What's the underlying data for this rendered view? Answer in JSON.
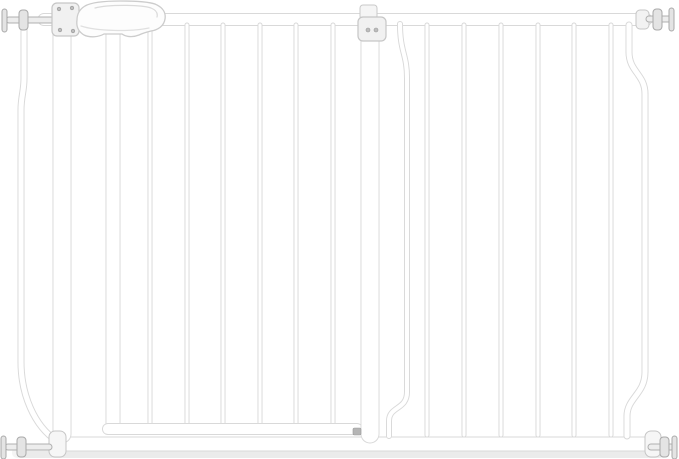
{
  "meta": {
    "width": 679,
    "height": 459,
    "background": "#ffffff",
    "subject": "white-metal-baby-safety-gate-with-extension"
  },
  "palette": {
    "tube_fill": "#ffffff",
    "tube_stroke": "#d9d9d9",
    "hardware_fill": "#f2f2f2",
    "hardware_stroke": "#c6c6c6",
    "bolt_fill": "#e4e4e4",
    "bolt_stroke": "#a9a9a9",
    "screw_fill": "#bdbdbd",
    "screw_stroke": "#999999",
    "latch_pin": "#b5b5b5",
    "shadow_soft": "#f4f4f4",
    "shadow_main": "#ebebeb"
  },
  "scene": {
    "shapes": [
      {
        "type": "rect",
        "name": "floor-shadow-soft",
        "attrs": {
          "x": 12,
          "y": 447,
          "width": 656,
          "height": 11,
          "rx": 5,
          "fill": "#f4f4f4"
        }
      },
      {
        "type": "rect",
        "name": "floor-shadow",
        "attrs": {
          "x": 22,
          "y": 451,
          "width": 640,
          "height": 7,
          "rx": 3,
          "fill": "#ebebeb"
        }
      },
      {
        "type": "tube",
        "name": "top-rail",
        "d": "M44,19.5 H646",
        "w": 13
      },
      {
        "type": "tube",
        "name": "bottom-rail",
        "d": "M57,444 H650",
        "w": 15
      },
      {
        "type": "tube",
        "name": "left-outer-bent-bar",
        "d": "M24,28 V78 C24,92 21,96 21,110 V362 C21,394 34,426 57,441",
        "w": 7
      },
      {
        "type": "tube",
        "name": "frame-hinge-post",
        "d": "M62,30 V434",
        "w": 19
      },
      {
        "type": "tube",
        "name": "door-hinge-stile",
        "d": "M113,30 V423",
        "w": 15
      },
      {
        "type": "tube",
        "name": "door-bar-1",
        "d": "M150,25 V424",
        "w": 5
      },
      {
        "type": "tube",
        "name": "door-bar-2",
        "d": "M187,25 V424",
        "w": 5
      },
      {
        "type": "tube",
        "name": "door-bar-3",
        "d": "M223,25 V424",
        "w": 5
      },
      {
        "type": "tube",
        "name": "door-bar-4",
        "d": "M260,25 V424",
        "w": 5
      },
      {
        "type": "tube",
        "name": "door-bar-5",
        "d": "M296,25 V424",
        "w": 5
      },
      {
        "type": "tube",
        "name": "door-bar-6",
        "d": "M333,25 V424",
        "w": 5
      },
      {
        "type": "tube",
        "name": "door-bottom-rail",
        "d": "M108,429 H357",
        "w": 12
      },
      {
        "type": "tube",
        "name": "frame-latch-post",
        "d": "M370,32 V434",
        "w": 19
      },
      {
        "type": "tube",
        "name": "extension-offset-bar",
        "d": "M400,24 C400,52 407,54 407,78 V392 C407,410 389,406 389,421 V436",
        "w": 6
      },
      {
        "type": "tube",
        "name": "extension-bar-1",
        "d": "M427,25 V435",
        "w": 5
      },
      {
        "type": "tube",
        "name": "extension-bar-2",
        "d": "M464,25 V435",
        "w": 5
      },
      {
        "type": "tube",
        "name": "extension-bar-3",
        "d": "M501,25 V435",
        "w": 5
      },
      {
        "type": "tube",
        "name": "extension-bar-4",
        "d": "M538,25 V435",
        "w": 5
      },
      {
        "type": "tube",
        "name": "extension-bar-5",
        "d": "M574,25 V435",
        "w": 5
      },
      {
        "type": "tube",
        "name": "extension-bar-6",
        "d": "M611,25 V435",
        "w": 5
      },
      {
        "type": "tube",
        "name": "right-outer-bent-bar",
        "d": "M629,25 V52 C629,72 645,74 645,94 V372 C645,394 627,398 627,416 V436",
        "w": 7
      },
      {
        "type": "rect",
        "name": "top-rail-right-collar",
        "attrs": {
          "x": 636,
          "y": 10,
          "width": 13,
          "height": 19,
          "rx": 4,
          "fill": "#f2f2f2",
          "stroke": "#c6c6c6",
          "stroke-width": 1
        }
      },
      {
        "type": "rect",
        "name": "bottom-rail-left-cap",
        "attrs": {
          "x": 49,
          "y": 431,
          "width": 17,
          "height": 26,
          "rx": 6,
          "fill": "#f6f6f6",
          "stroke": "#c6c6c6",
          "stroke-width": 1
        }
      },
      {
        "type": "rect",
        "name": "bottom-rail-right-cap",
        "attrs": {
          "x": 645,
          "y": 431,
          "width": 16,
          "height": 26,
          "rx": 6,
          "fill": "#f6f6f6",
          "stroke": "#c6c6c6",
          "stroke-width": 1
        }
      },
      {
        "type": "rect",
        "name": "pressure-bolt-top-left-spindle",
        "attrs": {
          "x": 6,
          "y": 17,
          "width": 50,
          "height": 6,
          "rx": 3,
          "fill": "#ededed",
          "stroke": "#b0b0b0",
          "stroke-width": 1
        }
      },
      {
        "type": "rect",
        "name": "pressure-bolt-top-left-handle",
        "attrs": {
          "x": 2,
          "y": 9,
          "width": 5,
          "height": 23,
          "rx": 2.5,
          "fill": "#e4e4e4",
          "stroke": "#a9a9a9",
          "stroke-width": 1
        }
      },
      {
        "type": "rect",
        "name": "pressure-bolt-top-left-disc",
        "attrs": {
          "x": 19,
          "y": 10,
          "width": 9,
          "height": 20,
          "rx": 3.5,
          "fill": "#e4e4e4",
          "stroke": "#a9a9a9",
          "stroke-width": 1
        }
      },
      {
        "type": "rect",
        "name": "pressure-bolt-top-right-spindle",
        "attrs": {
          "x": 646,
          "y": 16,
          "width": 26,
          "height": 6,
          "rx": 3,
          "fill": "#ededed",
          "stroke": "#b0b0b0",
          "stroke-width": 1
        }
      },
      {
        "type": "rect",
        "name": "pressure-bolt-top-right-disc",
        "attrs": {
          "x": 653,
          "y": 9,
          "width": 9,
          "height": 21,
          "rx": 3.5,
          "fill": "#e4e4e4",
          "stroke": "#a9a9a9",
          "stroke-width": 1
        }
      },
      {
        "type": "rect",
        "name": "pressure-bolt-top-right-handle",
        "attrs": {
          "x": 669,
          "y": 8,
          "width": 5,
          "height": 23,
          "rx": 2.5,
          "fill": "#e4e4e4",
          "stroke": "#a9a9a9",
          "stroke-width": 1
        }
      },
      {
        "type": "rect",
        "name": "pressure-bolt-bottom-left-spindle",
        "attrs": {
          "x": 5,
          "y": 444,
          "width": 47,
          "height": 6,
          "rx": 3,
          "fill": "#ededed",
          "stroke": "#b0b0b0",
          "stroke-width": 1
        }
      },
      {
        "type": "rect",
        "name": "pressure-bolt-bottom-left-handle",
        "attrs": {
          "x": 1,
          "y": 436,
          "width": 5,
          "height": 23,
          "rx": 2.5,
          "fill": "#e4e4e4",
          "stroke": "#a9a9a9",
          "stroke-width": 1
        }
      },
      {
        "type": "rect",
        "name": "pressure-bolt-bottom-left-disc",
        "attrs": {
          "x": 17,
          "y": 437,
          "width": 9,
          "height": 20,
          "rx": 3.5,
          "fill": "#e4e4e4",
          "stroke": "#a9a9a9",
          "stroke-width": 1
        }
      },
      {
        "type": "rect",
        "name": "pressure-bolt-bottom-right-spindle",
        "attrs": {
          "x": 648,
          "y": 444,
          "width": 26,
          "height": 6,
          "rx": 3,
          "fill": "#ededed",
          "stroke": "#b0b0b0",
          "stroke-width": 1
        }
      },
      {
        "type": "rect",
        "name": "pressure-bolt-bottom-right-disc",
        "attrs": {
          "x": 660,
          "y": 437,
          "width": 9,
          "height": 20,
          "rx": 3.5,
          "fill": "#e4e4e4",
          "stroke": "#a9a9a9",
          "stroke-width": 1
        }
      },
      {
        "type": "rect",
        "name": "pressure-bolt-bottom-right-handle",
        "attrs": {
          "x": 672,
          "y": 436,
          "width": 5,
          "height": 23,
          "rx": 2.5,
          "fill": "#e4e4e4",
          "stroke": "#a9a9a9",
          "stroke-width": 1
        }
      },
      {
        "type": "rect",
        "name": "hinge-mount-plate",
        "attrs": {
          "x": 52,
          "y": 3,
          "width": 27,
          "height": 33,
          "rx": 5,
          "fill": "#f1f1f1",
          "stroke": "#c6c6c6",
          "stroke-width": 1.2
        }
      },
      {
        "type": "circle",
        "name": "hinge-plate-screw-1",
        "attrs": {
          "cx": 59,
          "cy": 9,
          "r": 1.8,
          "fill": "#bdbdbd",
          "stroke": "#999999",
          "stroke-width": 0.6
        }
      },
      {
        "type": "circle",
        "name": "hinge-plate-screw-2",
        "attrs": {
          "cx": 72,
          "cy": 8,
          "r": 1.8,
          "fill": "#bdbdbd",
          "stroke": "#999999",
          "stroke-width": 0.6
        }
      },
      {
        "type": "circle",
        "name": "hinge-plate-screw-3",
        "attrs": {
          "cx": 60,
          "cy": 30,
          "r": 1.8,
          "fill": "#bdbdbd",
          "stroke": "#999999",
          "stroke-width": 0.6
        }
      },
      {
        "type": "circle",
        "name": "hinge-plate-screw-4",
        "attrs": {
          "cx": 73,
          "cy": 31,
          "r": 1.8,
          "fill": "#bdbdbd",
          "stroke": "#999999",
          "stroke-width": 0.6
        }
      },
      {
        "type": "path",
        "name": "latch-handle-body",
        "attrs": {
          "d": "M85,6 C92,2 104,1 120,1 C138,1 152,2 157,5 C163,8 166,13 165,19 C164,26 158,30 151,31 C147,32 143,33 139,35 C133,37.5 126,37 122,34 L104,34 C99,37 90,38 84,35 C79,32 76,27 77,20 C77,13 80,9 85,6 Z",
          "fill": "#fdfdfd",
          "stroke": "#cccccc",
          "stroke-width": 1.3
        }
      },
      {
        "type": "path",
        "name": "latch-handle-grip-inset",
        "attrs": {
          "d": "M95,8 C108,4.5 140,4.5 151,8 C156,10 158,13 157,17",
          "fill": "none",
          "stroke": "#dadada",
          "stroke-width": 1.2,
          "stroke-linecap": "round"
        }
      },
      {
        "type": "path",
        "name": "latch-handle-lower-seam",
        "attrs": {
          "d": "M81,26 C96,31 130,32 149,28",
          "fill": "none",
          "stroke": "#e0e0e0",
          "stroke-width": 1.2,
          "stroke-linecap": "round"
        }
      },
      {
        "type": "rect",
        "name": "extension-clamp-top-tab",
        "attrs": {
          "x": 360,
          "y": 5,
          "width": 17,
          "height": 14,
          "rx": 3,
          "fill": "#f5f5f5",
          "stroke": "#c9c9c9",
          "stroke-width": 1
        }
      },
      {
        "type": "rect",
        "name": "extension-clamp-plate",
        "attrs": {
          "x": 358,
          "y": 17,
          "width": 28,
          "height": 24,
          "rx": 5,
          "fill": "#f1f1f1",
          "stroke": "#c6c6c6",
          "stroke-width": 1.2
        }
      },
      {
        "type": "circle",
        "name": "extension-clamp-screw-1",
        "attrs": {
          "cx": 368,
          "cy": 30,
          "r": 2,
          "fill": "#bdbdbd",
          "stroke": "#999999",
          "stroke-width": 0.6
        }
      },
      {
        "type": "circle",
        "name": "extension-clamp-screw-2",
        "attrs": {
          "cx": 376,
          "cy": 30,
          "r": 2,
          "fill": "#bdbdbd",
          "stroke": "#999999",
          "stroke-width": 0.6
        }
      },
      {
        "type": "rect",
        "name": "door-bottom-latch-pin",
        "attrs": {
          "x": 353,
          "y": 428,
          "width": 8,
          "height": 7,
          "rx": 1.5,
          "fill": "#b5b5b5",
          "stroke": "#9b9b9b",
          "stroke-width": 0.6
        }
      }
    ]
  }
}
